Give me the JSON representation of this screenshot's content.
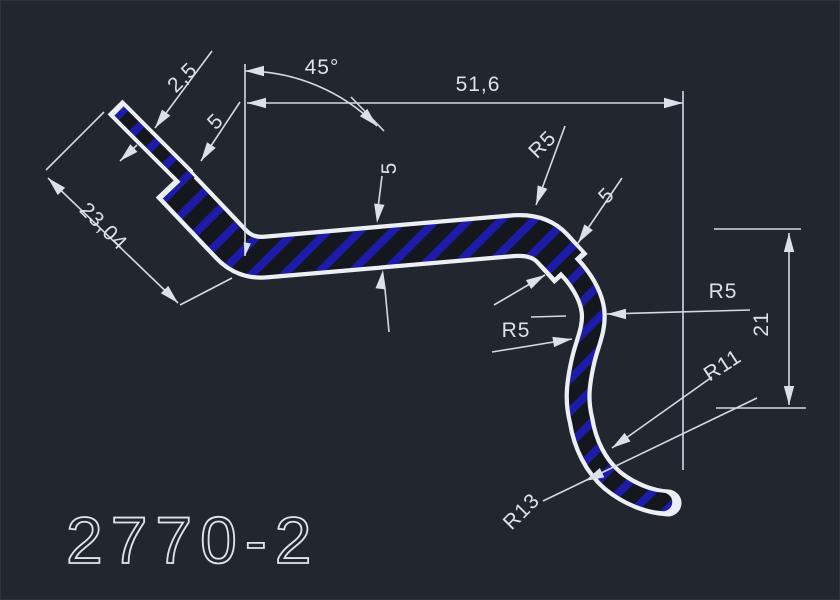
{
  "drawing": {
    "title": "2770-2",
    "dims": {
      "step": "2,5",
      "angle": "45°",
      "overall": "51,6",
      "arm_thickness": "5",
      "arm_length": "23,04",
      "web_thickness": "5",
      "top_radius": "R5",
      "leg_thickness": "5",
      "right_radius": "R5",
      "s_radius": "R5",
      "hook_height": "21",
      "inner_radius": "R11",
      "outer_radius": "R13"
    },
    "colors": {
      "background": "#22262e",
      "lines": "#eceff4",
      "hatch_blue": "#1c1ca8"
    }
  }
}
